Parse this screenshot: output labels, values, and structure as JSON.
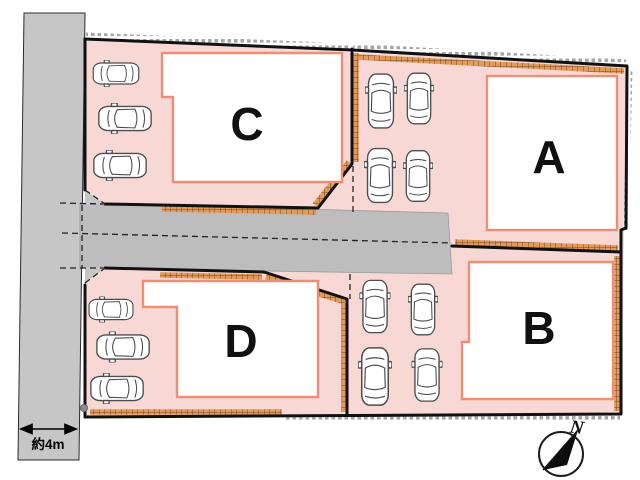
{
  "plan": {
    "title_hidden": "",
    "lots": [
      {
        "label": "A",
        "parking_cars": 4
      },
      {
        "label": "B",
        "parking_cars": 4
      },
      {
        "label": "C",
        "parking_cars": 3
      },
      {
        "label": "D",
        "parking_cars": 3
      }
    ],
    "road": {
      "width_label": "約4m"
    },
    "compass": {
      "label": "N"
    },
    "colors": {
      "lot_fill": "#f8d8d5",
      "building_border": "#ef8e76",
      "road_fill": "#c6c6c6",
      "driveway_fill": "#bdbdbd",
      "boundary_line": "#111111",
      "hatch_orange": "#e29a5b",
      "hatch_tick": "#79491d",
      "outer_tick": "#a6a6a6"
    }
  }
}
